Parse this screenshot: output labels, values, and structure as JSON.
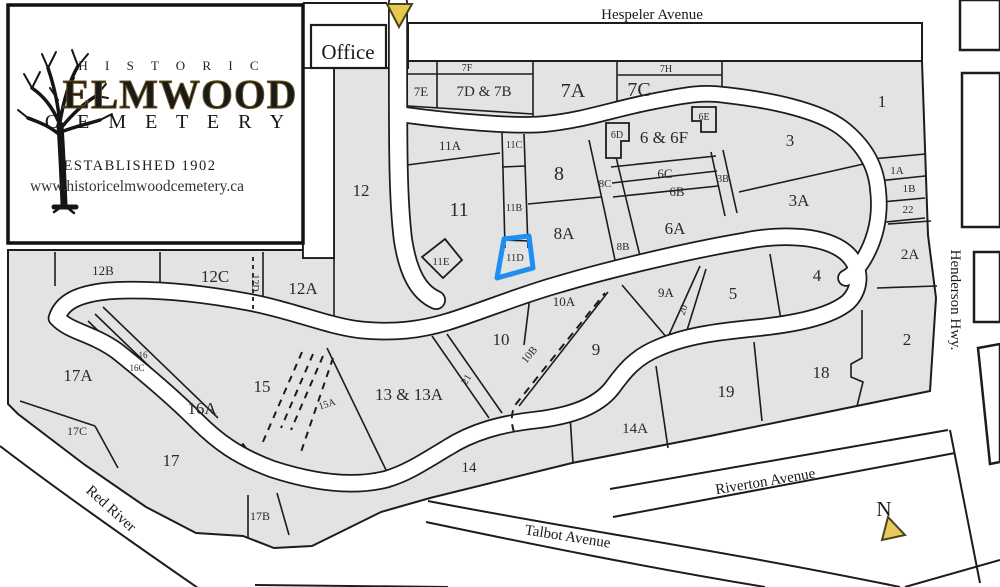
{
  "title": "Historic Elmwood Cemetery map",
  "logo": {
    "line1": "H I S T O R I C",
    "line2": "ELMWOOD",
    "line3": "C E M E T E R Y",
    "established": "ESTABLISHED 1902",
    "website": "www.historicelmwoodcemetery.ca"
  },
  "office": {
    "label": "Office"
  },
  "compass": {
    "label": "N"
  },
  "highlight": {
    "section": "11D",
    "color": "#1e8ff2"
  },
  "colors": {
    "ground": "#e3e3e3",
    "line": "#1c1c1c",
    "road": "#ffffff",
    "arrow_fill": "#e9c84f",
    "logo_gold": "#c49a45",
    "logo_est_gold": "#b98f3e"
  },
  "streets": [
    {
      "label": "Hespeler Avenue",
      "x": 652,
      "y": 19,
      "fs": 15,
      "rot": 0
    },
    {
      "label": "Henderson Hwy.",
      "x": 951,
      "y": 300,
      "fs": 15,
      "rot": 90
    },
    {
      "label": "Riverton Avenue",
      "x": 766,
      "y": 486,
      "fs": 15,
      "rot": -9.5
    },
    {
      "label": "Talbot Avenue",
      "x": 567,
      "y": 541,
      "fs": 15,
      "rot": 9
    },
    {
      "label": "Red River",
      "x": 108,
      "y": 512,
      "fs": 15,
      "rot": 42
    }
  ],
  "sections": [
    {
      "label": "7F",
      "x": 467,
      "y": 71,
      "fs": 10
    },
    {
      "label": "7E",
      "x": 421,
      "y": 96,
      "fs": 13
    },
    {
      "label": "7D & 7B",
      "x": 484,
      "y": 96,
      "fs": 15
    },
    {
      "label": "7A",
      "x": 573,
      "y": 97,
      "fs": 20
    },
    {
      "label": "7H",
      "x": 666,
      "y": 72,
      "fs": 10
    },
    {
      "label": "7C",
      "x": 639,
      "y": 96,
      "fs": 20
    },
    {
      "label": "1",
      "x": 882,
      "y": 107,
      "fs": 17
    },
    {
      "label": "11A",
      "x": 450,
      "y": 150,
      "fs": 13
    },
    {
      "label": "11C",
      "x": 514,
      "y": 148,
      "fs": 10
    },
    {
      "label": "8",
      "x": 559,
      "y": 180,
      "fs": 20
    },
    {
      "label": "6D",
      "x": 617,
      "y": 138,
      "fs": 10
    },
    {
      "label": "6 & 6F",
      "x": 664,
      "y": 143,
      "fs": 17
    },
    {
      "label": "6E",
      "x": 704,
      "y": 120,
      "fs": 10
    },
    {
      "label": "8C",
      "x": 605,
      "y": 187,
      "fs": 11
    },
    {
      "label": "6C",
      "x": 665,
      "y": 178,
      "fs": 13
    },
    {
      "label": "6B",
      "x": 677,
      "y": 196,
      "fs": 13
    },
    {
      "label": "3B",
      "x": 723,
      "y": 182,
      "fs": 10
    },
    {
      "label": "3",
      "x": 790,
      "y": 146,
      "fs": 17
    },
    {
      "label": "3A",
      "x": 799,
      "y": 206,
      "fs": 17
    },
    {
      "label": "1A",
      "x": 897,
      "y": 174,
      "fs": 11
    },
    {
      "label": "1B",
      "x": 909,
      "y": 192,
      "fs": 11
    },
    {
      "label": "22",
      "x": 908,
      "y": 213,
      "fs": 11
    },
    {
      "label": "11",
      "x": 459,
      "y": 216,
      "fs": 20
    },
    {
      "label": "11B",
      "x": 514,
      "y": 211,
      "fs": 10
    },
    {
      "label": "8A",
      "x": 564,
      "y": 239,
      "fs": 17
    },
    {
      "label": "8B",
      "x": 623,
      "y": 250,
      "fs": 11
    },
    {
      "label": "6A",
      "x": 675,
      "y": 234,
      "fs": 17
    },
    {
      "label": "11E",
      "x": 441,
      "y": 265,
      "fs": 11
    },
    {
      "label": "11D",
      "x": 515,
      "y": 261,
      "fs": 10.5
    },
    {
      "label": "2A",
      "x": 910,
      "y": 259,
      "fs": 15
    },
    {
      "label": "12",
      "x": 361,
      "y": 196,
      "fs": 17
    },
    {
      "label": "12B",
      "x": 103,
      "y": 275,
      "fs": 13
    },
    {
      "label": "12C",
      "x": 215,
      "y": 282,
      "fs": 17
    },
    {
      "label": "12D",
      "x": 252,
      "y": 283,
      "fs": 10,
      "rot": 90
    },
    {
      "label": "12A",
      "x": 303,
      "y": 294,
      "fs": 17
    },
    {
      "label": "4",
      "x": 817,
      "y": 281,
      "fs": 17
    },
    {
      "label": "5",
      "x": 733,
      "y": 299,
      "fs": 17
    },
    {
      "label": "9A",
      "x": 666,
      "y": 297,
      "fs": 13
    },
    {
      "label": "20",
      "x": 686,
      "y": 311,
      "fs": 10,
      "rot": -70
    },
    {
      "label": "10A",
      "x": 564,
      "y": 306,
      "fs": 13
    },
    {
      "label": "10",
      "x": 501,
      "y": 345,
      "fs": 17
    },
    {
      "label": "10B",
      "x": 532,
      "y": 357,
      "fs": 11,
      "rot": -50
    },
    {
      "label": "9",
      "x": 596,
      "y": 355,
      "fs": 17
    },
    {
      "label": "17A",
      "x": 78,
      "y": 381,
      "fs": 17
    },
    {
      "label": "16",
      "x": 143,
      "y": 358,
      "fs": 9
    },
    {
      "label": "16C",
      "x": 137,
      "y": 371,
      "fs": 9
    },
    {
      "label": "15",
      "x": 262,
      "y": 392,
      "fs": 17
    },
    {
      "label": "15A",
      "x": 328,
      "y": 407,
      "fs": 10,
      "rot": -18
    },
    {
      "label": "16A",
      "x": 202,
      "y": 414,
      "fs": 17
    },
    {
      "label": "13 & 13A",
      "x": 409,
      "y": 400,
      "fs": 17
    },
    {
      "label": "21",
      "x": 469,
      "y": 381,
      "fs": 10,
      "rot": -60
    },
    {
      "label": "14A",
      "x": 635,
      "y": 433,
      "fs": 15
    },
    {
      "label": "19",
      "x": 726,
      "y": 397,
      "fs": 17
    },
    {
      "label": "18",
      "x": 821,
      "y": 378,
      "fs": 17
    },
    {
      "label": "2",
      "x": 907,
      "y": 345,
      "fs": 17
    },
    {
      "label": "17C",
      "x": 77,
      "y": 435,
      "fs": 12
    },
    {
      "label": "17",
      "x": 171,
      "y": 466,
      "fs": 17
    },
    {
      "label": "17B",
      "x": 260,
      "y": 520,
      "fs": 12
    },
    {
      "label": "14",
      "x": 469,
      "y": 472,
      "fs": 15
    }
  ]
}
